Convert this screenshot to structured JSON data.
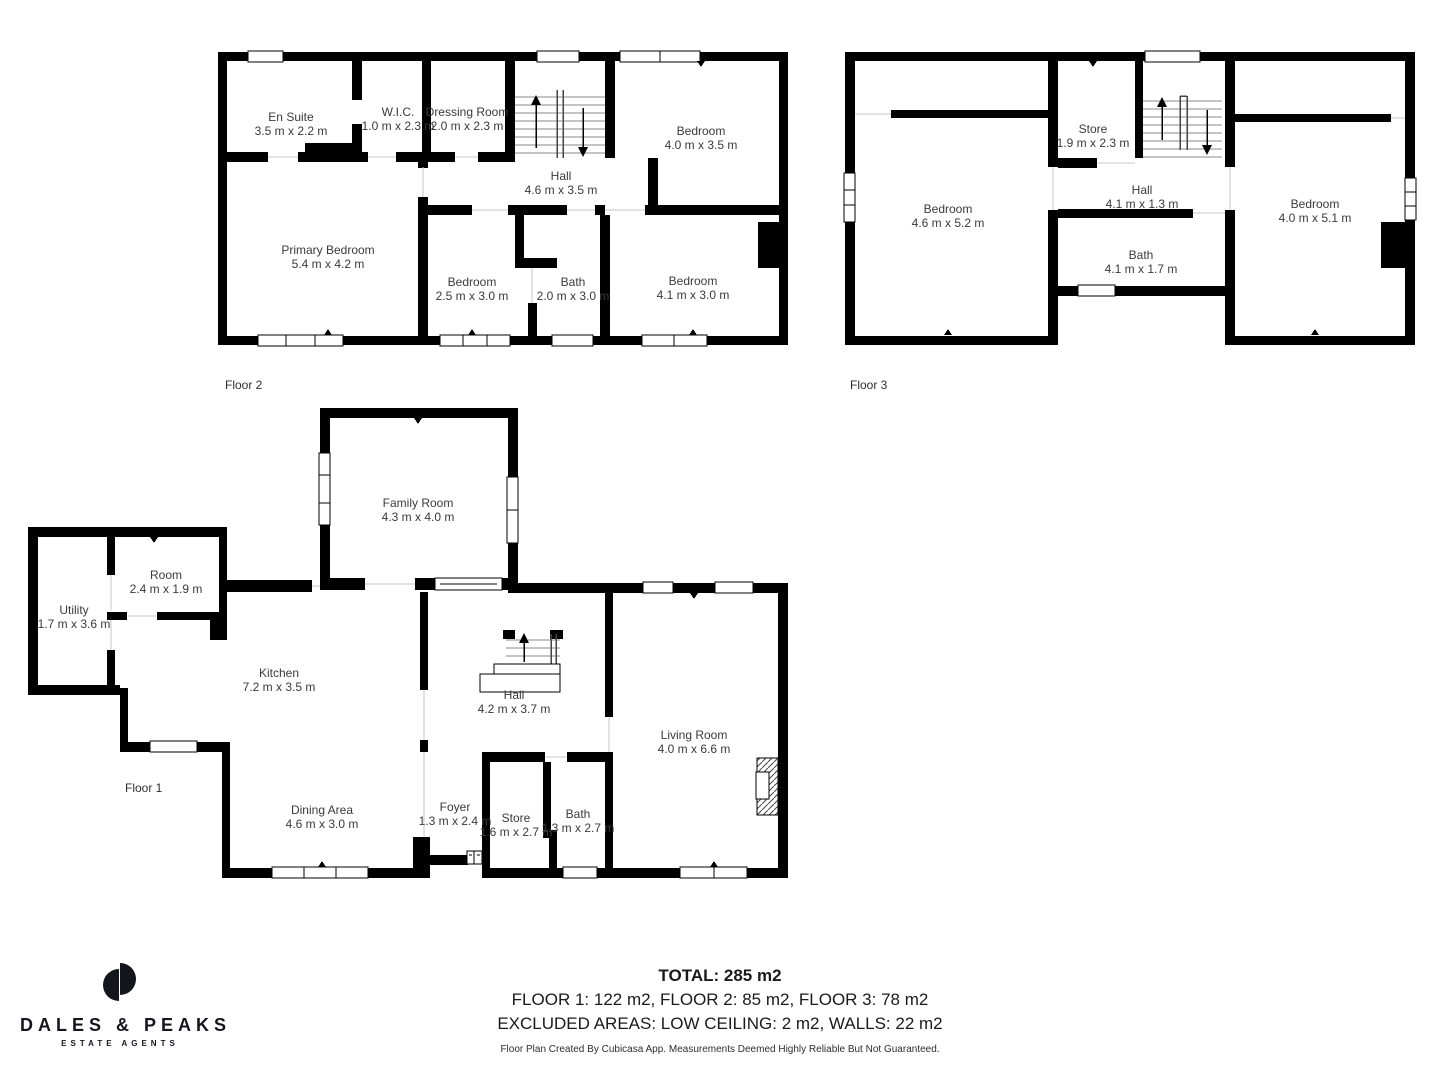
{
  "branding": {
    "name": "DALES & PEAKS",
    "tagline": "ESTATE AGENTS",
    "logo_icon": "split-circle",
    "color": "#15151d"
  },
  "colors": {
    "walls": "#000000",
    "room_text": "#3a3a3a",
    "background": "#ffffff"
  },
  "footer": {
    "total": "TOTAL: 285 m2",
    "floors": "FLOOR 1: 122 m2, FLOOR 2: 85 m2, FLOOR 3: 78 m2",
    "excluded": "EXCLUDED AREAS: LOW CEILING: 2 m2, WALLS: 22 m2",
    "disclaimer": "Floor Plan Created By Cubicasa App. Measurements Deemed Highly Reliable But Not Guaranteed."
  },
  "floors": {
    "floor2": {
      "label": "Floor 2",
      "rooms": {
        "en_suite": {
          "name": "En Suite",
          "dims": "3.5 m x 2.2 m"
        },
        "wic": {
          "name": "W.I.C.",
          "dims": "1.0 m x 2.3 m"
        },
        "dressing_room": {
          "name": "Dressing Room",
          "dims": "2.0 m x 2.3 m"
        },
        "bedroom_1": {
          "name": "Bedroom",
          "dims": "4.0 m x 3.5 m"
        },
        "hall": {
          "name": "Hall",
          "dims": "4.6 m x 3.5 m"
        },
        "primary_bedroom": {
          "name": "Primary Bedroom",
          "dims": "5.4 m x 4.2 m"
        },
        "bedroom_2": {
          "name": "Bedroom",
          "dims": "2.5 m x 3.0 m"
        },
        "bath": {
          "name": "Bath",
          "dims": "2.0 m x 3.0 m"
        },
        "bedroom_3": {
          "name": "Bedroom",
          "dims": "4.1 m x 3.0 m"
        }
      }
    },
    "floor3": {
      "label": "Floor 3",
      "rooms": {
        "bedroom_left": {
          "name": "Bedroom",
          "dims": "4.6 m x 5.2 m"
        },
        "store": {
          "name": "Store",
          "dims": "1.9 m x 2.3 m"
        },
        "hall": {
          "name": "Hall",
          "dims": "4.1 m x 1.3 m"
        },
        "bath": {
          "name": "Bath",
          "dims": "4.1 m x 1.7 m"
        },
        "bedroom_right": {
          "name": "Bedroom",
          "dims": "4.0 m x 5.1 m"
        }
      }
    },
    "floor1": {
      "label": "Floor 1",
      "rooms": {
        "family_room": {
          "name": "Family Room",
          "dims": "4.3 m x 4.0 m"
        },
        "room": {
          "name": "Room",
          "dims": "2.4 m x 1.9 m"
        },
        "utility": {
          "name": "Utility",
          "dims": "1.7 m x 3.6 m"
        },
        "kitchen": {
          "name": "Kitchen",
          "dims": "7.2 m x 3.5 m"
        },
        "hall": {
          "name": "Hall",
          "dims": "4.2 m x 3.7 m"
        },
        "living_room": {
          "name": "Living Room",
          "dims": "4.0 m x 6.6 m"
        },
        "dining_area": {
          "name": "Dining Area",
          "dims": "4.6 m x 3.0 m"
        },
        "foyer": {
          "name": "Foyer",
          "dims": "1.3 m x 2.4 m"
        },
        "store": {
          "name": "Store",
          "dims": "1.6 m x 2.7 m"
        },
        "bath": {
          "name": "Bath",
          "dims": "1.3 m x 2.7 m"
        }
      }
    }
  }
}
